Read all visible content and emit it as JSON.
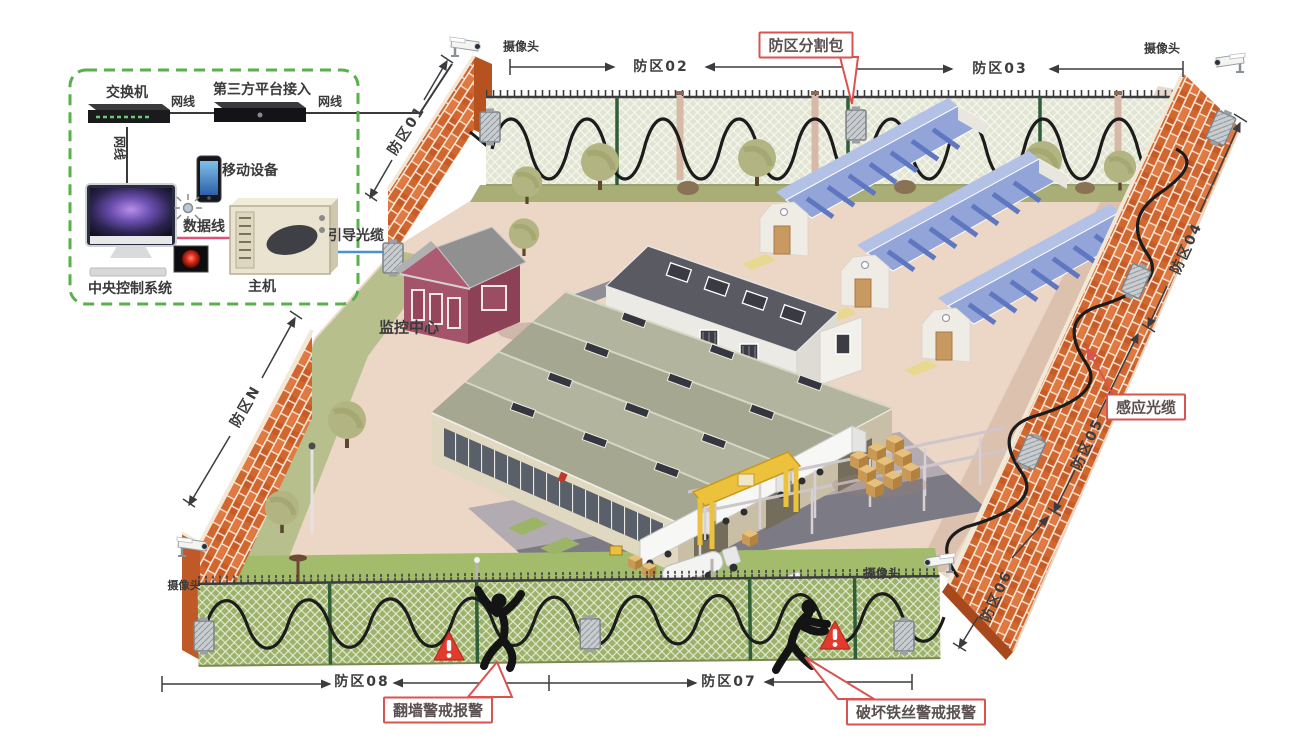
{
  "control_room": {
    "switch": "交换机",
    "third_party": "第三方平台接入",
    "net_cable_a": "网线",
    "net_cable_b": "网线",
    "net_cable_c": "网线",
    "mobile_device": "移动设备",
    "data_cable": "数据线",
    "central_control": "中央控制系统",
    "host": "主机",
    "guide_cable": "引导光缆"
  },
  "site": {
    "monitoring_center": "监控中心",
    "camera_top_left": "摄像头",
    "camera_top_right": "摄像头",
    "camera_bottom_left": "摄像头",
    "camera_bottom_right": "摄像头"
  },
  "zones": {
    "z01": "防区01",
    "z02": "防区02",
    "z03": "防区03",
    "z04": "防区04",
    "z05": "防区05",
    "z06": "防区06",
    "z07": "防区07",
    "z08": "防区08",
    "zn": "防区N"
  },
  "callouts": {
    "zone_splitter": "防区分割包",
    "sensing_cable": "感应光缆",
    "climb_alarm": "翻墙警戒报警",
    "cut_wire_alarm": "破坏铁丝警戒报警"
  },
  "colors": {
    "brick": "#d2662f",
    "brick_light": "#e07a42",
    "mortar": "#f5e9da",
    "fence_post_green": "#2f5e38",
    "grass_top": "#a9ae76",
    "grass_bottom": "#a2bc6c",
    "ground": "#ecd6c6",
    "roof_blue": "#93a4d8",
    "roof_grey": "#5a5a62",
    "warehouse_wall": "#c9bfa6",
    "callout_red": "#d9534f",
    "dashed_green": "#58b14a",
    "cable_black": "#1c1c1c",
    "guide_cable_blue": "#4a90d9",
    "data_cable_pink": "#e0507a",
    "alarm_red": "#e23b2e"
  }
}
